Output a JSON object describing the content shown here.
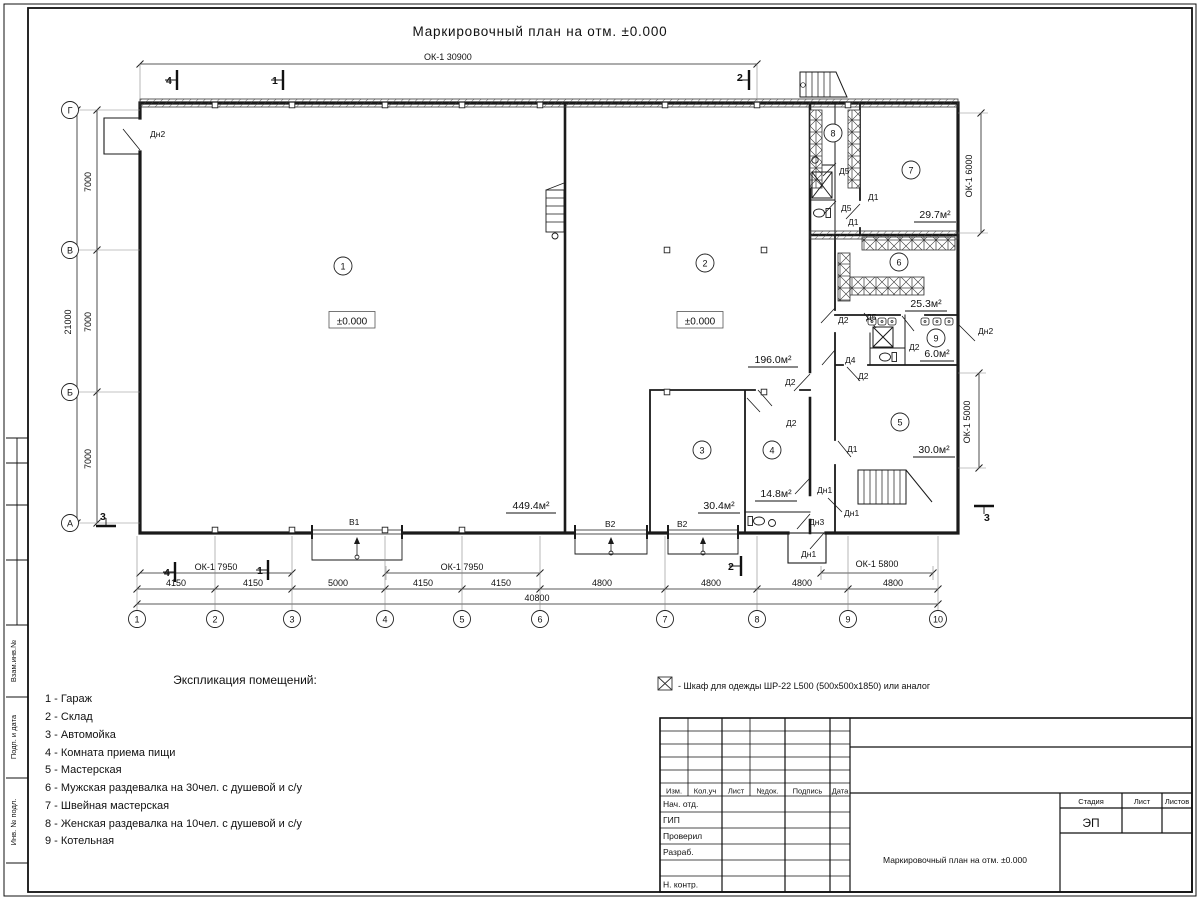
{
  "title": "Маркировочный план на отм. ±0.000",
  "plan": {
    "window_total": "ОК-1 30900",
    "elevation": "±0.000",
    "room_nums": [
      "1",
      "2",
      "3",
      "4",
      "5",
      "6",
      "7",
      "8",
      "9"
    ],
    "areas": {
      "r1": "449.4м²",
      "r2": "196.0м²",
      "r3": "30.4м²",
      "r4": "14.8м²",
      "r5": "30.0м²",
      "r6": "25.3м²",
      "r7": "29.7м²",
      "r9": "6.0м²"
    },
    "doors": {
      "d1": "Д1",
      "d2": "Д2",
      "d4": "Д4",
      "d5": "Д5",
      "dn1": "Дн1",
      "dn2": "Дн2",
      "dn3": "Дн3"
    },
    "gates": {
      "v1": "В1",
      "v2": "В2"
    },
    "sections": {
      "s1": "1",
      "s2": "2",
      "s3": "3",
      "s4": "4"
    },
    "grid_cols": [
      "1",
      "2",
      "3",
      "4",
      "5",
      "6",
      "7",
      "8",
      "9",
      "10"
    ],
    "grid_rows": [
      "А",
      "Б",
      "В",
      "Г"
    ],
    "dims_bottom": [
      "4150",
      "4150",
      "5000",
      "4150",
      "4150",
      "4800",
      "4800",
      "4800",
      "4800"
    ],
    "dim_total": "40800",
    "dims_left": [
      "7000",
      "7000",
      "7000"
    ],
    "dim_left_total": "21000",
    "window_dims": [
      "ОК-1 7950",
      "ОК-1 7950",
      "ОК-1 5800",
      "ОК-1 6000",
      "ОК-1 5000"
    ]
  },
  "legend": {
    "title": "Экспликация помещений:",
    "items": [
      "1 - Гараж",
      "2 - Склад",
      "3 - Автомойка",
      "4 - Комната приема пищи",
      "5 - Мастерская",
      "6 - Мужская раздевалка на 30чел. с душевой и с/у",
      "7 - Швейная мастерская",
      "8 - Женская раздевалка на 10чел. с душевой и с/у",
      "9 - Котельная"
    ]
  },
  "cabinet_note": "- Шкаф для одежды ШР-22 L500 (500x500x1850) или аналог",
  "titleblock": {
    "cols": [
      "Изм.",
      "Кол.уч",
      "Лист",
      "№док.",
      "Подпись",
      "Дата"
    ],
    "rows": [
      "Нач. отд.",
      "ГИП",
      "Проверил",
      "Разраб.",
      "Н. контр."
    ],
    "stage_label": "Стадия",
    "sheet_label": "Лист",
    "sheets_label": "Листов",
    "stage_value": "ЭП",
    "doc_title": "Маркировочный план на отм. ±0.000"
  },
  "side_stamp": [
    "Инв. № подл.",
    "Подп. и дата",
    "Взам.инв.№"
  ]
}
